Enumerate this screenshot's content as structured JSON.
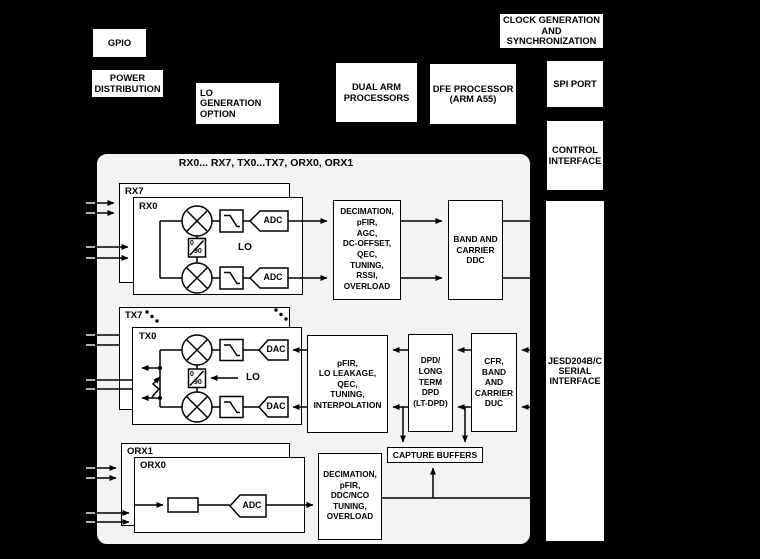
{
  "colors": {
    "background": "#000000",
    "chip_fill": "#f3f3f3",
    "block_fill": "#ffffff",
    "line": "#000000"
  },
  "peripherals": {
    "gpio": "GPIO",
    "power_distribution": "POWER\nDISTRIBUTION",
    "lo_generation": "LO GENERATION\nOPTION",
    "dual_arm": "DUAL ARM\nPROCESSORS",
    "dfe_processor": "DFE PROCESSOR\n(ARM A55)",
    "clock_generation": "CLOCK GENERATION\nAND\nSYNCHRONIZATION",
    "spi_port": "SPI PORT",
    "control_interface": "CONTROL\nINTERFACE",
    "jesd": "JESD204B/C\nSERIAL\nINTERFACE"
  },
  "chip": {
    "title": "RX0... RX7, TX0...TX7, ORX0, ORX1",
    "rx": {
      "outer": "RX7",
      "inner": "RX0",
      "adc_top": "ADC",
      "adc_bottom": "ADC",
      "lo": "LO",
      "phase_0": "0",
      "phase_90": "90",
      "dsp": "DECIMATION,\npFIR,\nAGC,\nDC-OFFSET,\nQEC,\nTUNING,\nRSSI,\nOVERLOAD",
      "ddc": "BAND AND\nCARRIER\nDDC"
    },
    "tx": {
      "outer": "TX7",
      "inner": "TX0",
      "dac_top": "DAC",
      "dac_bottom": "DAC",
      "lo": "LO",
      "phase_0": "0",
      "phase_90": "90",
      "dsp": "pFIR,\nLO LEAKAGE,\nQEC,\nTUNING,\nINTERPOLATION",
      "dpd": "DPD/\nLONG\nTERM\nDPD\n(LT-DPD)",
      "cfr": "CFR,\nBAND\nAND\nCARRIER\nDUC"
    },
    "orx": {
      "outer": "ORX1",
      "inner": "ORX0",
      "adc": "ADC",
      "dsp": "DECIMATION,\npFIR,\nDDC/NCO\nTUNING,\nOVERLOAD"
    },
    "capture_buffers": "CAPTURE BUFFERS"
  }
}
